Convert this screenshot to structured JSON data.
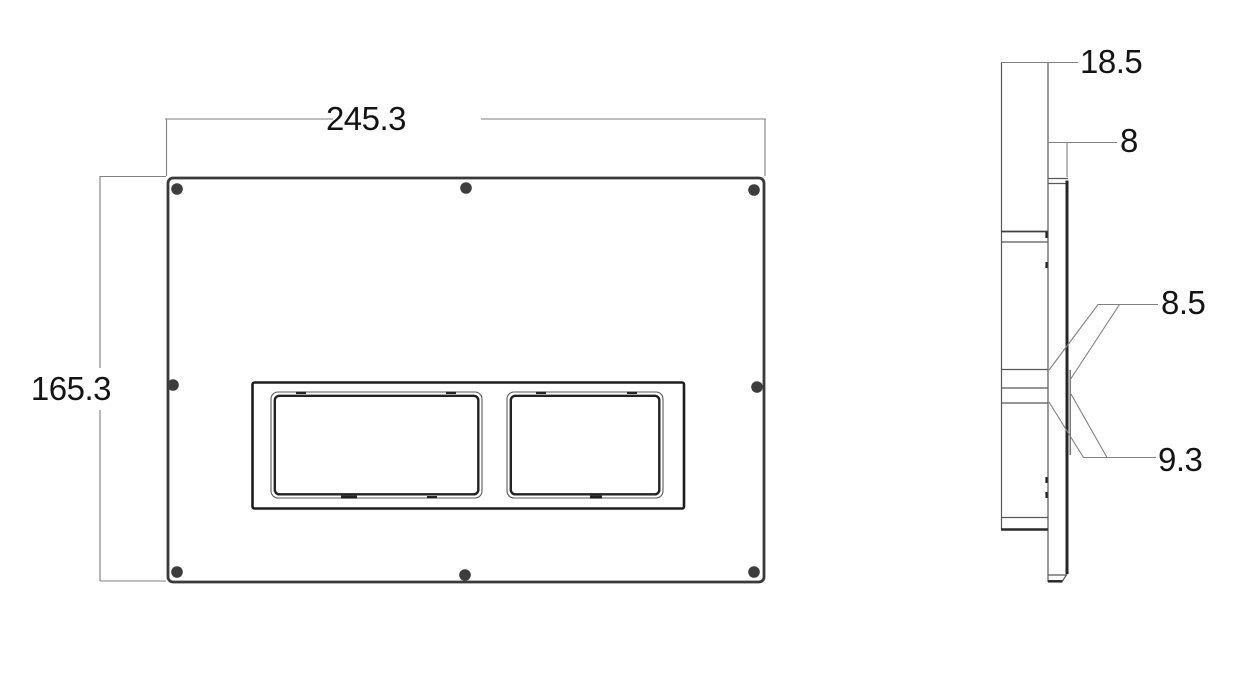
{
  "page": {
    "background": "#ffffff"
  },
  "drawing": {
    "colors": {
      "plate_outline": "#3a3a3a",
      "drawing_line": "#585858",
      "dimension_line": "#7f7f7f",
      "dimension_text": "#141414",
      "screw_hole": "#3d3d3d"
    },
    "front_view": {
      "width_dim": "245.3",
      "height_dim": "165.3",
      "screw_hole_count": 8,
      "button_opening_count": 2
    },
    "side_view": {
      "depth_dim": "18.5",
      "plate_thickness_dim": "8",
      "upper_step_dim": "8.5",
      "lower_step_dim": "9.3"
    }
  }
}
